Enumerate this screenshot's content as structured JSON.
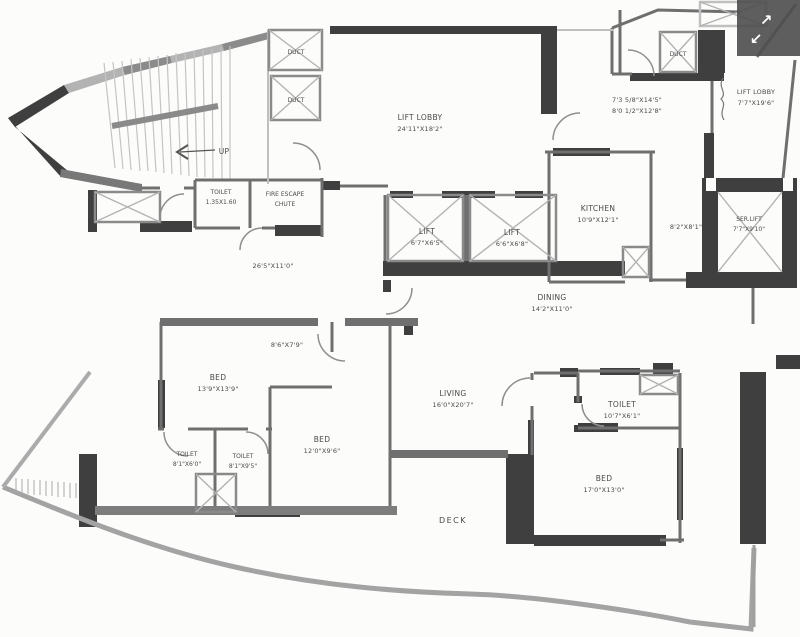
{
  "plan": {
    "up_label": "UP",
    "duct1": "DUCT",
    "duct2": "DUCT",
    "duct3": "DUCT",
    "lift_lobby_main": {
      "name": "LIFT LOBBY",
      "dims": "24'11\"X18'2\""
    },
    "foyer_dims_line1": "7'3 5/8\"X14'5\"",
    "foyer_dims_line2": "8'0 1/2\"X12'8\"",
    "lift_lobby_right": {
      "name": "LIFT LOBBY",
      "dims": "7'7\"X19'6\""
    },
    "toilet_small": {
      "name": "TOILET",
      "dims": "1.35X1.60"
    },
    "fire_escape": {
      "line1": "FIRE ESCAPE",
      "line2": "CHUTE"
    },
    "kitchen": {
      "name": "KITCHEN",
      "dims": "10'9\"X12'1\""
    },
    "passage_dims_right": "8'2\"X8'1\"",
    "ser_lift": {
      "name": "SER.LIFT",
      "dims": "7'7\"X9'10\""
    },
    "lift1": {
      "name": "LIFT",
      "dims": "6'7\"X6'5\""
    },
    "lift2": {
      "name": "LIFT",
      "dims": "6'6\"X6'8\""
    },
    "passage_dims_left": "26'5\"X11'0\"",
    "dining": {
      "name": "DINING",
      "dims": "14'2\"X11'0\""
    },
    "foyer2_dims": "8'6\"X7'9\"",
    "bed1": {
      "name": "BED",
      "dims": "13'9\"X13'9\""
    },
    "living": {
      "name": "LIVING",
      "dims": "16'0\"X20'7\""
    },
    "toilet_br": {
      "name": "TOILET",
      "dims": "10'7\"X6'1\""
    },
    "toilet_bl1": {
      "name": "TOILET",
      "dims": "8'1\"X6'0\""
    },
    "toilet_bl2": {
      "name": "TOILET",
      "dims": "8'1\"X9'5\""
    },
    "bed2": {
      "name": "BED",
      "dims": "12'0\"X9'6\""
    },
    "bed3": {
      "name": "BED",
      "dims": "17'0\"X13'0\""
    },
    "deck": "DECK"
  },
  "viewer": {
    "expand_ne": "↗",
    "expand_sw": "↙"
  },
  "colors": {
    "wall_dark": "#3f3f3f",
    "wall_mid": "#6f6f6f",
    "wall_light": "#a6a6a6",
    "overlay_bg": "#4d4d4d",
    "overlay_arrow": "#ffffff",
    "text": "#4a4a4a",
    "background": "#fcfcfb"
  }
}
